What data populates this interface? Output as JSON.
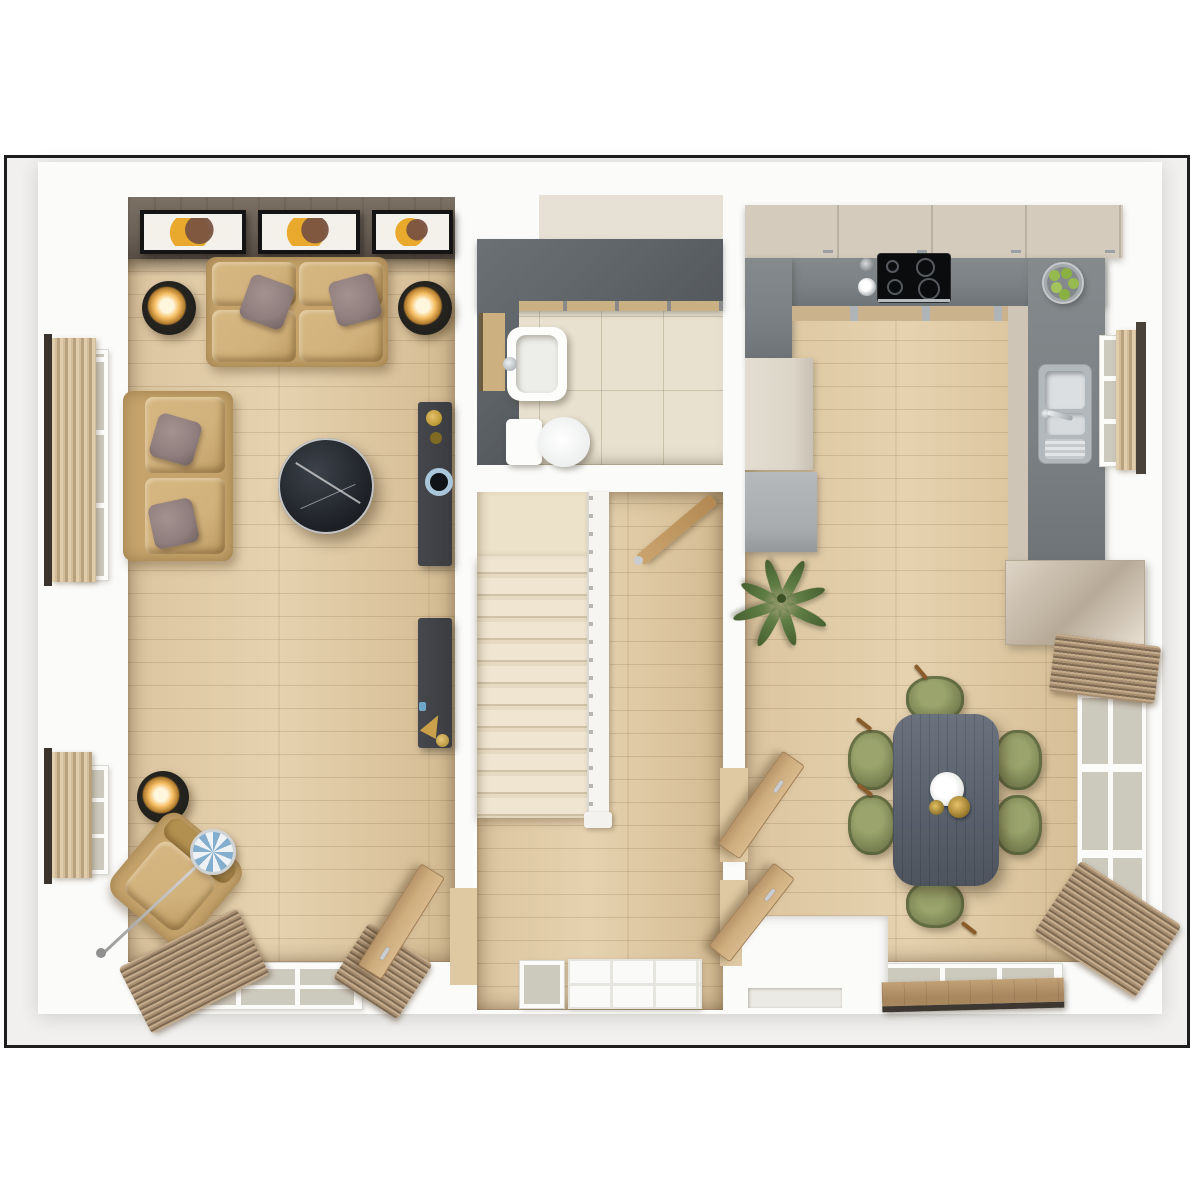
{
  "meta": {
    "description": "Top-down 3D rendered ground-floor plan: living room (left), WC and staircase hall (centre), kitchen-diner (right). No text is rendered in the image.",
    "visible_text": ""
  },
  "palette": {
    "frame": "#1d1d1d",
    "exterior": "#f1f0ee",
    "wall": "#fbfbfa",
    "wood": "#dcc5a0",
    "feature_wall": "#6e6359",
    "slate": "#5f6468",
    "counter": "#7a8083",
    "tile": "#e9e1d0",
    "carpet": "#ece1c9",
    "sofa": "#c5a36b",
    "sofa_light": "#d2b27c",
    "pillow": "#8f7e7d",
    "marble": "#1c1f24",
    "media": "#3a3c40",
    "table": "#5c636e",
    "chair": "#7e8756",
    "chair_dark": "#5d653e",
    "door_wood": "#cead7d",
    "drape": "#a88e70",
    "curtain": "#d3bd9b",
    "cabinet": "#d5cbbd",
    "cream_unit": "#dcd5c8",
    "gray_unit": "#a8acae",
    "steel": "#c3c7ca",
    "glow": "#f5bd62",
    "apple": "#96ba50",
    "plant": "#5f7d45",
    "brass": "#bb9733",
    "blue": "#a9c6da",
    "glass": "#ccc9bd",
    "art_amber": "#e8a92c",
    "carpet_steps": "#efe5d1"
  },
  "scene": {
    "rooms": [
      {
        "id": "living-room",
        "objects": [
          "feature wall with 3 framed artworks",
          "three-seat sofa",
          "two-seat sofa",
          "round black marble coffee table",
          "2 media sideboards",
          "armchair with arc lamp",
          "3 glowing floor lamps",
          "2 side windows with curtains",
          "bottom window with drapes",
          "open wooden door"
        ]
      },
      {
        "id": "wc",
        "objects": [
          "wash basin",
          "toilet",
          "slate feature walls",
          "tiled floor",
          "vanity shelf"
        ]
      },
      {
        "id": "hallway",
        "objects": [
          "carpeted staircase with white banister",
          "wall handrail / open door",
          "front door with glazed sidelight"
        ]
      },
      {
        "id": "kitchen-diner",
        "objects": [
          "U-shaped slate worktop",
          "4-ring hob",
          "double steel sink with drainer",
          "fruit bowl with apples",
          "upper cabinets",
          "tall cream unit",
          "gray appliance unit",
          "gloss sideboard",
          "palm plant",
          "dining table with decor",
          "6 olive chairs",
          "2 open wooden doors",
          "3 windows with drapes"
        ]
      }
    ],
    "counts": {
      "art_frames": 3,
      "dining_chairs": 6,
      "stair_steps": 12,
      "hob_burners": 4,
      "floor_lamps": 3
    }
  }
}
